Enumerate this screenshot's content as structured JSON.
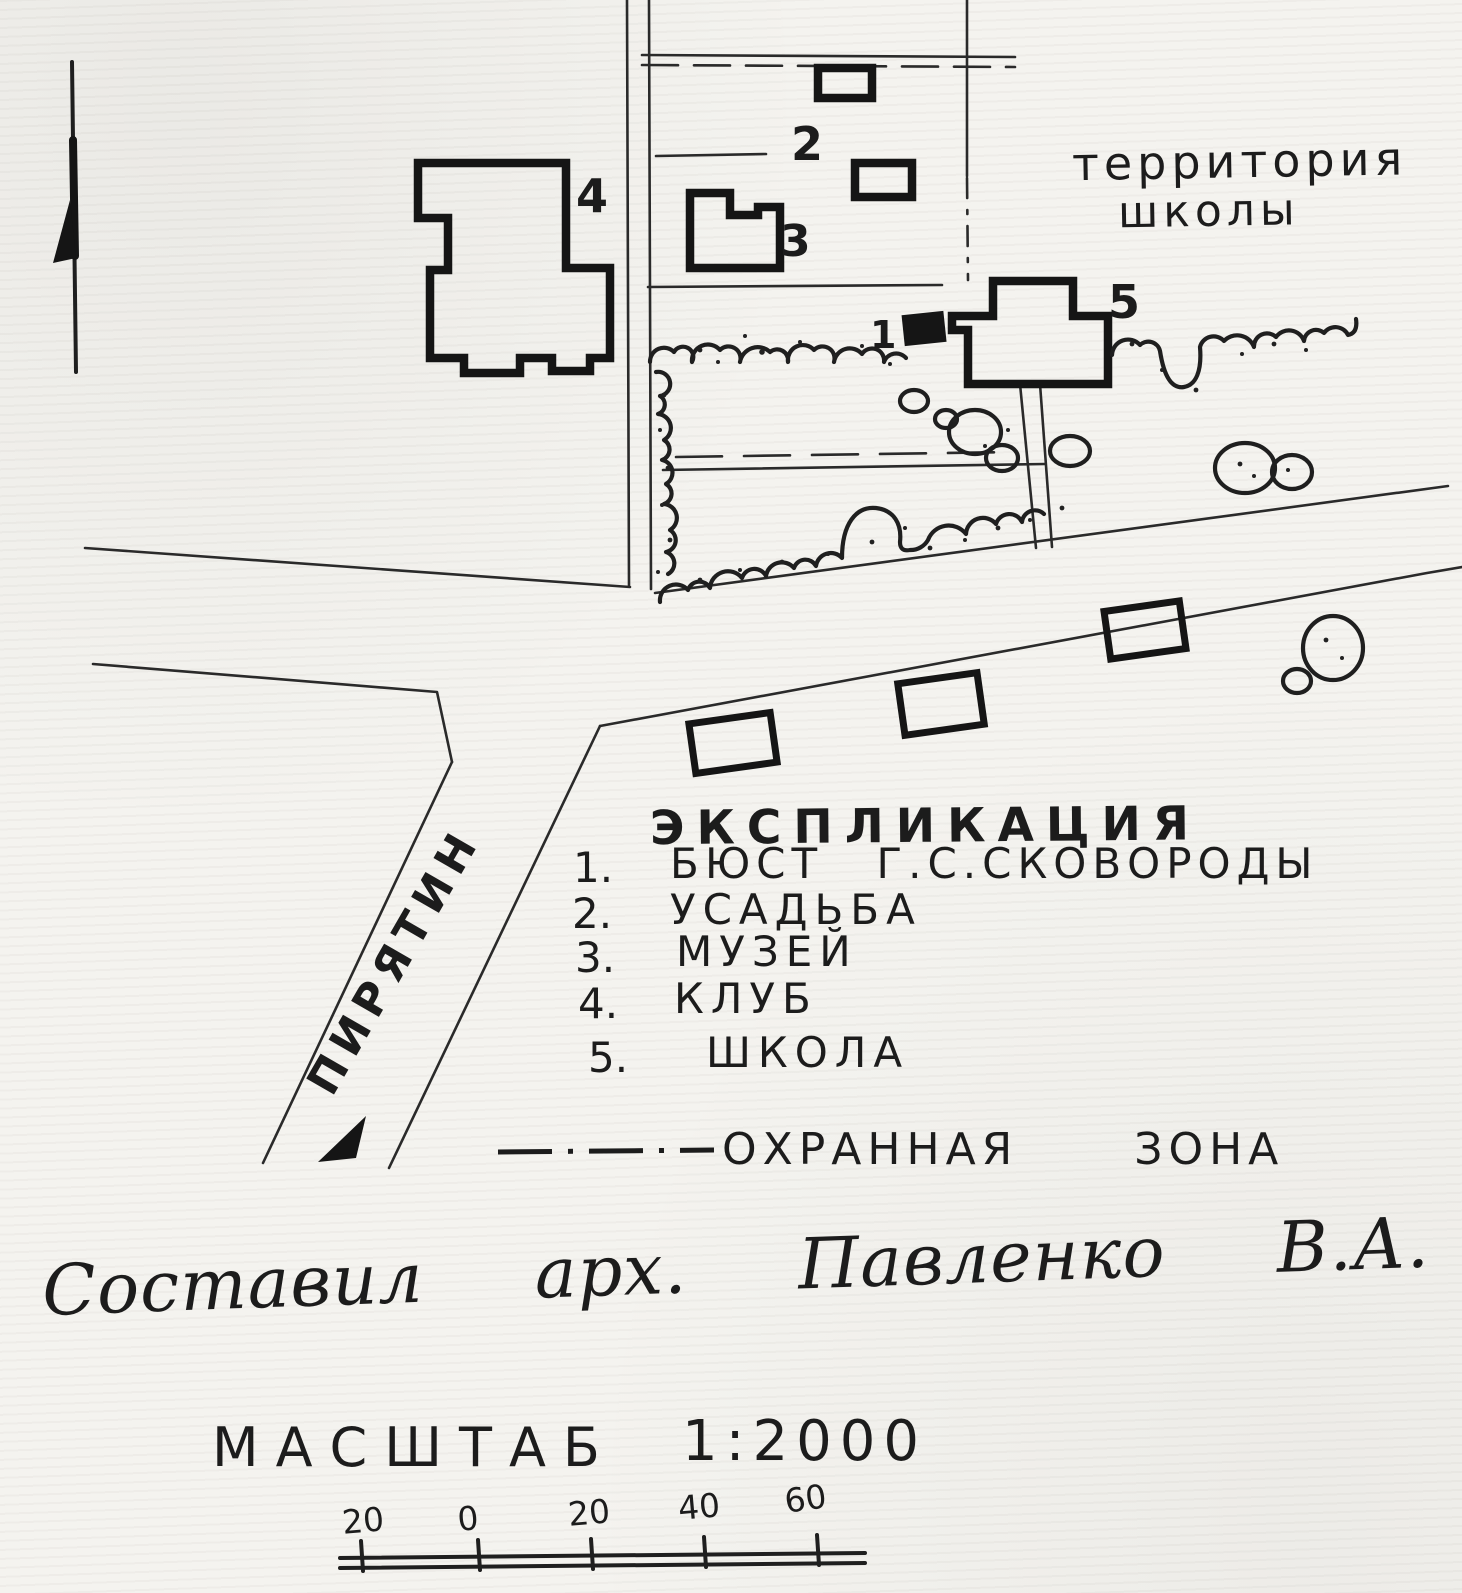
{
  "map": {
    "territory_label": {
      "line1": "территория",
      "line2": "школы"
    },
    "road_label": "ПИРЯТИН",
    "markers": {
      "m1": "1",
      "m2": "2",
      "m3": "3",
      "m4": "4",
      "m5": "5"
    }
  },
  "legend": {
    "title": "ЭКСПЛИКАЦИЯ",
    "items": [
      {
        "num": "1.",
        "label": "БЮСТ Г.С.СКОВОРОДЫ"
      },
      {
        "num": "2.",
        "label": "УСАДЬБА"
      },
      {
        "num": "3.",
        "label": "МУЗЕЙ"
      },
      {
        "num": "4.",
        "label": "КЛУБ"
      },
      {
        "num": "5.",
        "label": "ШКОЛА"
      }
    ],
    "zone_label": "ОХРАННАЯ ЗОНА"
  },
  "signature": {
    "text": "Составил арх. Павленко В.А. 1984г."
  },
  "scale": {
    "label": "МАСШТАБ",
    "ratio": "1:2000",
    "bar_labels": [
      "20",
      "0",
      "20",
      "40",
      "60"
    ]
  },
  "colors": {
    "ink": "#1c1c1c",
    "paper": "#f4f3ef"
  }
}
